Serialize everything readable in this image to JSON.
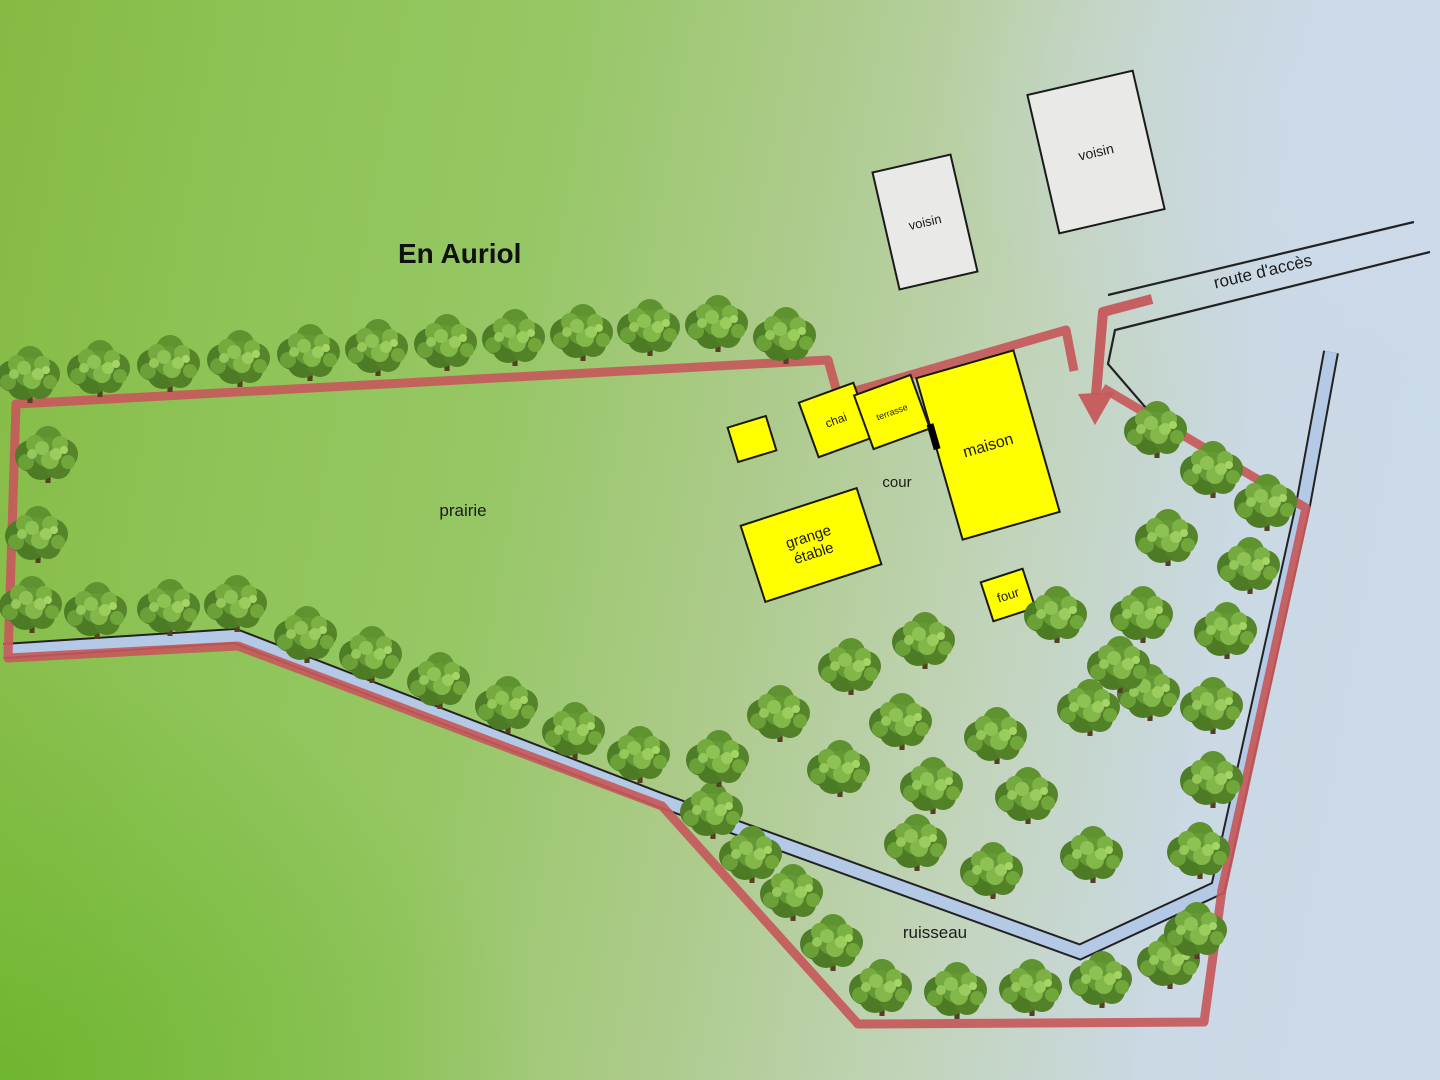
{
  "title": {
    "text": "En Auriol"
  },
  "area_labels": {
    "prairie": "prairie",
    "cour": "cour",
    "ruisseau": "ruisseau",
    "route": "route d'accès"
  },
  "colors": {
    "boundary_red": "#c5595b",
    "stream_blue": "#b3c9e6",
    "outline_black": "#222222",
    "building_yellow": "#ffff00",
    "neighbor_gray": "#e9e9e7",
    "building_stroke": "#1a1a1a",
    "text_dark": "#1b1b1b"
  },
  "map": {
    "boundary_points": [
      [
        1103,
        388
      ],
      [
        1306,
        508
      ],
      [
        1222,
        890
      ],
      [
        1204,
        1022
      ],
      [
        858,
        1024
      ],
      [
        662,
        806
      ],
      [
        238,
        646
      ],
      [
        8,
        658
      ],
      [
        16,
        404
      ],
      [
        828,
        360
      ],
      [
        838,
        396
      ],
      [
        1066,
        330
      ],
      [
        1074,
        371
      ]
    ],
    "stream_points": [
      [
        4,
        651
      ],
      [
        235,
        636
      ],
      [
        660,
        800
      ],
      [
        1080,
        952
      ],
      [
        1218,
        888
      ],
      [
        1303,
        505
      ],
      [
        1331,
        352
      ]
    ],
    "road": {
      "line1": [
        [
          1108,
          295
        ],
        [
          1414,
          222
        ]
      ],
      "line2": [
        [
          1430,
          252
        ],
        [
          1115,
          330
        ],
        [
          1108,
          364
        ],
        [
          1152,
          415
        ]
      ]
    },
    "arrow": {
      "shaft": [
        [
          1152,
          299
        ],
        [
          1103,
          312
        ],
        [
          1096,
          395
        ]
      ],
      "head": [
        [
          1078,
          394
        ],
        [
          1114,
          392
        ],
        [
          1095,
          425
        ]
      ]
    },
    "buildings": [
      {
        "id": "shed",
        "lines": [],
        "cx": 752,
        "cy": 439,
        "w": 40,
        "h": 36,
        "rot": -17,
        "type": "yellow",
        "font": 0
      },
      {
        "id": "chai",
        "lines": [
          "chai"
        ],
        "cx": 836,
        "cy": 420,
        "w": 58,
        "h": 58,
        "rot": -20,
        "type": "yellow",
        "font": 12
      },
      {
        "id": "terrasse",
        "lines": [
          "terrasse"
        ],
        "cx": 892,
        "cy": 412,
        "w": 60,
        "h": 57,
        "rot": -20,
        "type": "yellow",
        "font": 9
      },
      {
        "id": "maison",
        "lines": [
          "maison"
        ],
        "cx": 988,
        "cy": 445,
        "w": 101,
        "h": 168,
        "rot": -16,
        "type": "yellow",
        "font": 16,
        "door": true
      },
      {
        "id": "grange-etable",
        "lines": [
          "grange",
          "étable"
        ],
        "cx": 811,
        "cy": 545,
        "w": 122,
        "h": 80,
        "rot": -18,
        "type": "yellow",
        "font": 15
      },
      {
        "id": "four",
        "lines": [
          "four"
        ],
        "cx": 1008,
        "cy": 595,
        "w": 44,
        "h": 41,
        "rot": -18,
        "type": "yellow",
        "font": 13
      },
      {
        "id": "voisin-1",
        "lines": [
          "voisin"
        ],
        "cx": 925,
        "cy": 222,
        "w": 80,
        "h": 120,
        "rot": -13,
        "type": "gray",
        "font": 13
      },
      {
        "id": "voisin-2",
        "lines": [
          "voisin"
        ],
        "cx": 1096,
        "cy": 152,
        "w": 108,
        "h": 142,
        "rot": -13,
        "type": "gray",
        "font": 14
      }
    ],
    "trees": [
      [
        30,
        402
      ],
      [
        100,
        396
      ],
      [
        170,
        391
      ],
      [
        240,
        386
      ],
      [
        310,
        380
      ],
      [
        378,
        375
      ],
      [
        447,
        370
      ],
      [
        515,
        365
      ],
      [
        583,
        360
      ],
      [
        650,
        355
      ],
      [
        718,
        351
      ],
      [
        786,
        363
      ],
      [
        48,
        482
      ],
      [
        38,
        562
      ],
      [
        32,
        632
      ],
      [
        97,
        638
      ],
      [
        170,
        635
      ],
      [
        237,
        631
      ],
      [
        307,
        662
      ],
      [
        372,
        682
      ],
      [
        440,
        708
      ],
      [
        508,
        732
      ],
      [
        575,
        758
      ],
      [
        640,
        782
      ],
      [
        713,
        838
      ],
      [
        752,
        882
      ],
      [
        793,
        920
      ],
      [
        833,
        970
      ],
      [
        882,
        1015
      ],
      [
        957,
        1018
      ],
      [
        1032,
        1015
      ],
      [
        1102,
        1007
      ],
      [
        1170,
        988
      ],
      [
        917,
        870
      ],
      [
        993,
        898
      ],
      [
        1093,
        882
      ],
      [
        1200,
        878
      ],
      [
        1197,
        958
      ],
      [
        1213,
        807
      ],
      [
        1150,
        720
      ],
      [
        1213,
        733
      ],
      [
        1157,
        457
      ],
      [
        1213,
        497
      ],
      [
        1267,
        530
      ],
      [
        1168,
        565
      ],
      [
        1250,
        593
      ],
      [
        1143,
        642
      ],
      [
        1227,
        658
      ],
      [
        851,
        694
      ],
      [
        925,
        668
      ],
      [
        1057,
        642
      ],
      [
        1120,
        692
      ],
      [
        780,
        741
      ],
      [
        902,
        749
      ],
      [
        997,
        763
      ],
      [
        1090,
        735
      ],
      [
        719,
        786
      ],
      [
        840,
        796
      ],
      [
        933,
        813
      ],
      [
        1028,
        823
      ]
    ]
  }
}
